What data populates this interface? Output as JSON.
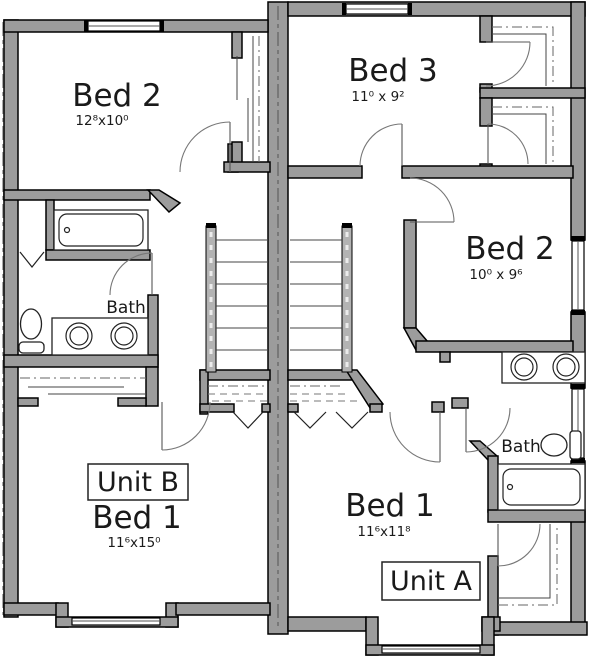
{
  "plan": {
    "unit_a": {
      "label": "Unit A",
      "bed1": {
        "name": "Bed 1",
        "dims": "11⁶x11⁸"
      },
      "bed2": {
        "name": "Bed 2",
        "dims": "10⁰ x 9⁶"
      },
      "bed3": {
        "name": "Bed 3",
        "dims": "11⁰ x 9²"
      },
      "bath": {
        "label": "Bath"
      }
    },
    "unit_b": {
      "label": "Unit B",
      "bed1": {
        "name": "Bed 1",
        "dims": "11⁶x15⁰"
      },
      "bed2": {
        "name": "Bed 2",
        "dims": "12⁸x10⁰"
      },
      "bath": {
        "label": "Bath"
      }
    }
  },
  "colors": {
    "wall": "#9c9c9c",
    "text": "#1a1a1a",
    "background": "#ffffff"
  }
}
